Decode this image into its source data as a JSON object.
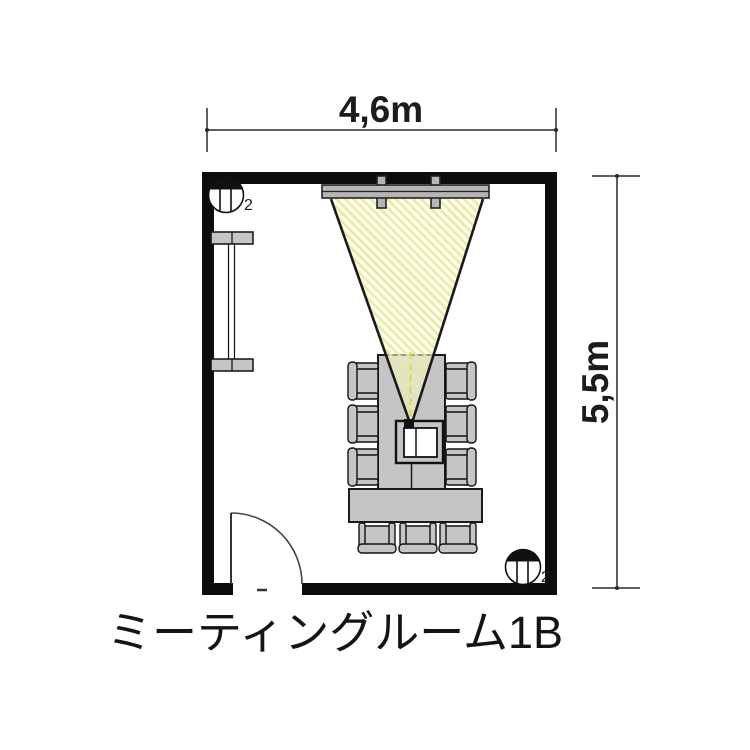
{
  "room": {
    "name": "ミーティングルーム1B",
    "width_label": "4,6m",
    "height_label": "5,5m"
  },
  "lights": {
    "top_left": {
      "count": "2"
    },
    "bottom_right": {
      "count": "2"
    }
  },
  "colors": {
    "wall": "#0d0d0d",
    "furniture": "#c5c5c5",
    "screen": "#b5b5b5",
    "cone_base": "#fbfbdf",
    "cone_hatch": "#e7e79b",
    "cone_edge": "#1a1a1a",
    "centerline": "#d9d95c",
    "dimension_line": "#2a2a2a"
  }
}
